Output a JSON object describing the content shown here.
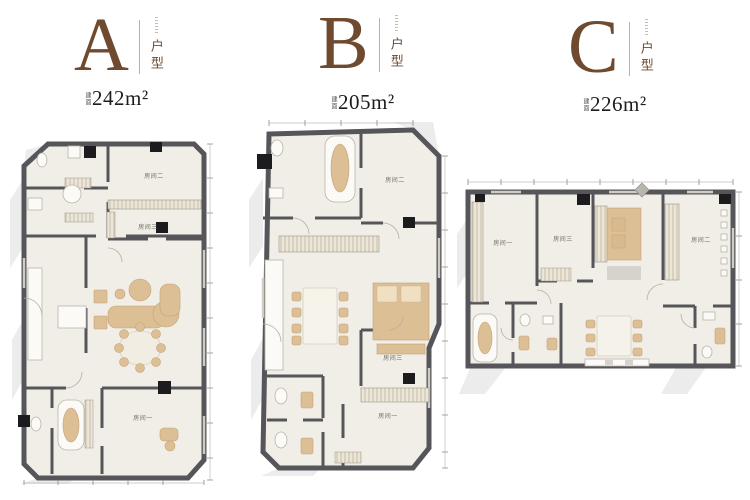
{
  "units": [
    {
      "letter": "A",
      "type_label": "户型",
      "area_prefix": "建面",
      "area": "242m²",
      "rooms": {
        "room1": "房间一",
        "room2": "房间二",
        "room3": "房间三"
      }
    },
    {
      "letter": "B",
      "type_label": "户型",
      "area_prefix": "建面",
      "area": "205m²",
      "rooms": {
        "room1": "房间一",
        "room2": "房间二",
        "room3": "房间三"
      }
    },
    {
      "letter": "C",
      "type_label": "户型",
      "area_prefix": "建面",
      "area": "226m²",
      "rooms": {
        "room1": "房间一",
        "room2": "房间二",
        "room3": "房间三"
      }
    }
  ],
  "colors": {
    "brand_brown": "#6F4A2E",
    "divider_tan": "#C8AE8F",
    "wall_gray": "#55555A",
    "floor": "#F0EEE7",
    "furniture_tan": "#DDBF96",
    "shadow_gray": "#ECECEC",
    "label_gray": "#6F6B65",
    "area_text": "#1D1D1D"
  }
}
